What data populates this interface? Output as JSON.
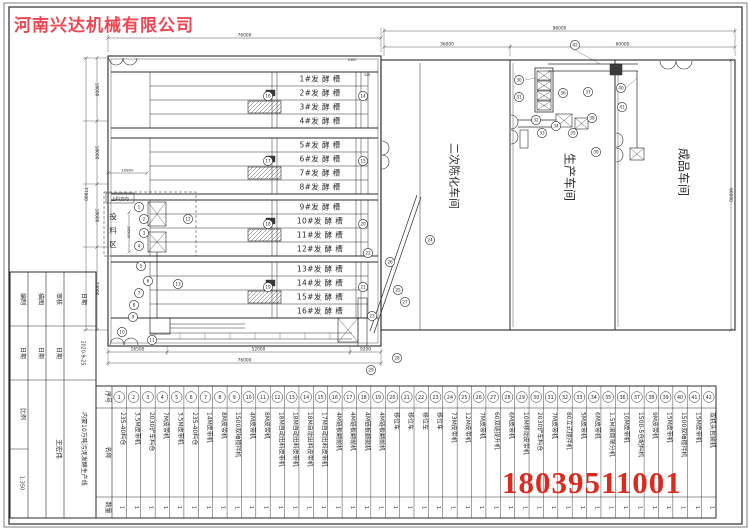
{
  "colors": {
    "company_red": "#ee4653",
    "phone_red": "#dd2a1f",
    "ink": "#2b2b2b"
  },
  "company": "河南兴达机械有限公司",
  "phone": "18039511001",
  "plan": {
    "tanks": [
      "1#发 酵 槽",
      "2#发 酵 槽",
      "3#发 酵 槽",
      "4#发 酵 槽",
      "5#发 酵 槽",
      "6#发 酵 槽",
      "7#发 酵 槽",
      "8#发 酵 槽",
      "9#发 酵 槽",
      "10#发 酵 槽",
      "11#发 酵 槽",
      "12#发 酵 槽",
      "13#发 酵 槽",
      "14#发 酵 槽",
      "15#发 酵 槽",
      "16#发 酵 槽"
    ],
    "workshops": {
      "secondary_aging": "二次陈化车间",
      "production": "生产车间",
      "finished": "成品车间"
    },
    "feed_zone": {
      "label": "投料区",
      "direction": "上料方向"
    },
    "dims": {
      "top_left": "76000",
      "top_total": "96000",
      "sec_a": "36000",
      "sec_b": "60000",
      "right_side": "60000",
      "left_total": "77000",
      "left_segs": [
        "18000",
        "18000",
        "18000",
        "23000"
      ],
      "feed_width": "10800",
      "feed_depth": "18500",
      "bottom_segs": [
        "16500",
        "52000",
        "9200"
      ],
      "bottom_total": "76000",
      "small_a": "4400",
      "small_b": "325"
    }
  },
  "callouts": [
    {
      "n": "1",
      "x": 139,
      "y": 207
    },
    {
      "n": "2",
      "x": 144,
      "y": 219
    },
    {
      "n": "3",
      "x": 144,
      "y": 233
    },
    {
      "n": "4",
      "x": 139,
      "y": 246
    },
    {
      "n": "5",
      "x": 141,
      "y": 266
    },
    {
      "n": "6",
      "x": 148,
      "y": 281
    },
    {
      "n": "7",
      "x": 139,
      "y": 293
    },
    {
      "n": "8",
      "x": 134,
      "y": 305
    },
    {
      "n": "9",
      "x": 133,
      "y": 317
    },
    {
      "n": "10",
      "x": 122,
      "y": 332
    },
    {
      "n": "11",
      "x": 152,
      "y": 340
    },
    {
      "n": "12",
      "x": 188,
      "y": 219
    },
    {
      "n": "13",
      "x": 178,
      "y": 284
    },
    {
      "n": "14",
      "x": 363,
      "y": 96
    },
    {
      "n": "15",
      "x": 363,
      "y": 161
    },
    {
      "n": "16",
      "x": 268,
      "y": 96
    },
    {
      "n": "17",
      "x": 268,
      "y": 161
    },
    {
      "n": "18",
      "x": 268,
      "y": 224
    },
    {
      "n": "19",
      "x": 268,
      "y": 287
    },
    {
      "n": "20",
      "x": 363,
      "y": 224
    },
    {
      "n": "21",
      "x": 363,
      "y": 287
    },
    {
      "n": "22",
      "x": 368,
      "y": 253
    },
    {
      "n": "23",
      "x": 372,
      "y": 316
    },
    {
      "n": "24",
      "x": 430,
      "y": 240
    },
    {
      "n": "25",
      "x": 398,
      "y": 290
    },
    {
      "n": "26",
      "x": 390,
      "y": 262
    },
    {
      "n": "27",
      "x": 405,
      "y": 302
    },
    {
      "n": "28",
      "x": 397,
      "y": 358
    },
    {
      "n": "29",
      "x": 371,
      "y": 370
    },
    {
      "n": "30",
      "x": 519,
      "y": 80
    },
    {
      "n": "31",
      "x": 519,
      "y": 97
    },
    {
      "n": "32",
      "x": 536,
      "y": 120
    },
    {
      "n": "33",
      "x": 542,
      "y": 133
    },
    {
      "n": "34",
      "x": 556,
      "y": 126
    },
    {
      "n": "35",
      "x": 573,
      "y": 133
    },
    {
      "n": "36",
      "x": 563,
      "y": 93
    },
    {
      "n": "37",
      "x": 588,
      "y": 92
    },
    {
      "n": "38",
      "x": 592,
      "y": 118
    },
    {
      "n": "39",
      "x": 596,
      "y": 152
    },
    {
      "n": "40",
      "x": 621,
      "y": 88
    },
    {
      "n": "41",
      "x": 622,
      "y": 107
    },
    {
      "n": "42",
      "x": 575,
      "y": 45
    }
  ],
  "parts_table": {
    "headers": {
      "index": "序号",
      "name": "名称",
      "qty": "数量"
    },
    "items": [
      {
        "no": "1",
        "name": "235-40料仓",
        "qty": "1"
      },
      {
        "no": "2",
        "name": "3.5M皮带机",
        "qty": "1"
      },
      {
        "no": "3",
        "name": "2030铲车料仓",
        "qty": "1"
      },
      {
        "no": "4",
        "name": "7M皮带机",
        "qty": "1"
      },
      {
        "no": "5",
        "name": "3.5M皮带机",
        "qty": "1"
      },
      {
        "no": "6",
        "name": "235-40料仓",
        "qty": "1"
      },
      {
        "no": "7",
        "name": "14M皮带机",
        "qty": "1"
      },
      {
        "no": "8",
        "name": "8M皮带机",
        "qty": "1"
      },
      {
        "no": "9",
        "name": "1500双轴搅拌机",
        "qty": "1"
      },
      {
        "no": "10",
        "name": "4M皮带机",
        "qty": "1"
      },
      {
        "no": "11",
        "name": "8M皮带机",
        "qty": "1"
      },
      {
        "no": "12",
        "name": "18M自动出料皮带机",
        "qty": "1"
      },
      {
        "no": "13",
        "name": "18M自动出料皮带机",
        "qty": "1"
      },
      {
        "no": "14",
        "name": "18M自动出料皮带机",
        "qty": "1"
      },
      {
        "no": "15",
        "name": "17M自动出料皮带机",
        "qty": "1"
      },
      {
        "no": "16",
        "name": "4M链板翻抛机",
        "qty": "1"
      },
      {
        "no": "17",
        "name": "4M链板翻抛机",
        "qty": "1"
      },
      {
        "no": "18",
        "name": "4M链板翻抛机",
        "qty": "1"
      },
      {
        "no": "19",
        "name": "4M链板翻抛机",
        "qty": "1"
      },
      {
        "no": "20",
        "name": "移位车",
        "qty": "1"
      },
      {
        "no": "21",
        "name": "移位车",
        "qty": "1"
      },
      {
        "no": "22",
        "name": "移位车",
        "qty": "1"
      },
      {
        "no": "23",
        "name": "移位车",
        "qty": "1"
      },
      {
        "no": "24",
        "name": "73M皮带机",
        "qty": "1"
      },
      {
        "no": "25",
        "name": "12M皮带机",
        "qty": "1"
      },
      {
        "no": "26",
        "name": "7M皮带机",
        "qty": "1"
      },
      {
        "no": "27",
        "name": "60双链提升机",
        "qty": "1"
      },
      {
        "no": "28",
        "name": "6M皮带机",
        "qty": "1"
      },
      {
        "no": "29",
        "name": "10M移动皮带机",
        "qty": "1"
      },
      {
        "no": "30",
        "name": "2030铲车料仓",
        "qty": "1"
      },
      {
        "no": "31",
        "name": "7M皮带机",
        "qty": "1"
      },
      {
        "no": "32",
        "name": "80立式搅拌机",
        "qty": "1"
      },
      {
        "no": "33",
        "name": "5M皮带机",
        "qty": "1"
      },
      {
        "no": "34",
        "name": "6M皮带机",
        "qty": "1"
      },
      {
        "no": "35",
        "name": "1.5M滚筒筛分机",
        "qty": "1"
      },
      {
        "no": "36",
        "name": "10M皮带机",
        "qty": "1"
      },
      {
        "no": "37",
        "name": "1500-5仓配料机",
        "qty": "1"
      },
      {
        "no": "38",
        "name": "9M皮带机",
        "qty": "1"
      },
      {
        "no": "39",
        "name": "15M皮带机",
        "qty": "1"
      },
      {
        "no": "40",
        "name": "1500双轴搅拌机",
        "qty": "1"
      },
      {
        "no": "41",
        "name": "15M皮带机",
        "qty": "1"
      },
      {
        "no": "42",
        "name": "双机头包装机",
        "qty": "1"
      }
    ]
  },
  "title_block": {
    "project": "内蒙10万吨污泥发酵生产线",
    "author": "王宏伟",
    "date": "2020-9-25",
    "scale_label": "比例",
    "scale": "1:350",
    "cells": [
      "编制",
      "描图",
      "审核",
      "日期",
      "日期",
      "日期",
      "日期",
      "2020-9-25",
      "比例",
      "1:350",
      "王宏伟",
      "内蒙10万吨污泥发酵生产线"
    ]
  }
}
